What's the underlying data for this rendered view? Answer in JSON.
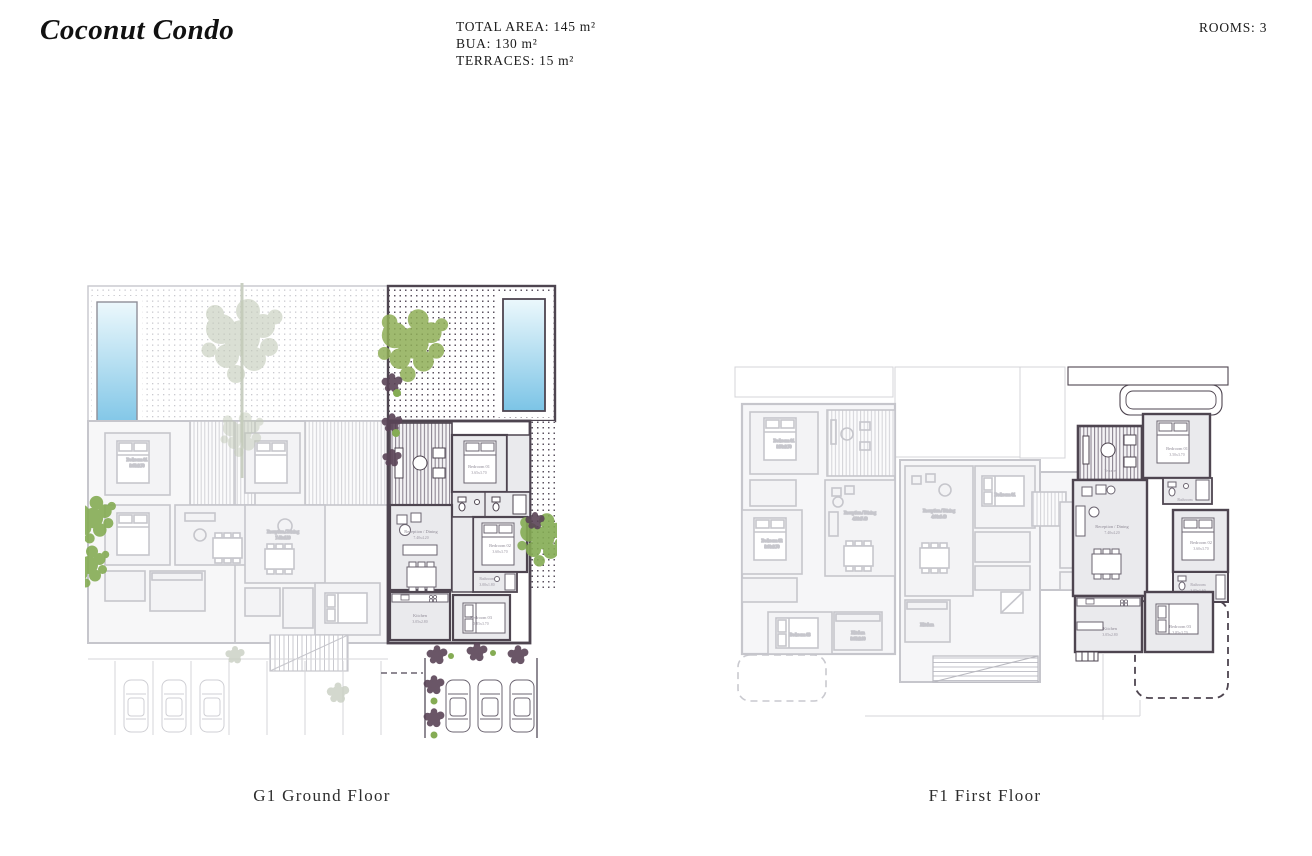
{
  "header": {
    "title": "Coconut Condo",
    "stats": {
      "total_area": "TOTAL AREA: 145 m²",
      "bua": "BUA: 130 m²",
      "terraces": "TERRACES: 15 m²"
    },
    "rooms_count": "ROOMS: 3"
  },
  "plans": {
    "ground": {
      "caption": "G1 Ground Floor",
      "rooms": {
        "bedroom1": {
          "name": "Bedroom 01",
          "dims": "3.65x3.70"
        },
        "bedroom2": {
          "name": "Bedroom 02",
          "dims": "3.60x3.70"
        },
        "bedroom3": {
          "name": "Bedroom 03",
          "dims": "3.85x3.70"
        },
        "reception": {
          "name": "Reception / Dining",
          "dims": "7.40x4.20"
        },
        "kitchen": {
          "name": "Kitchen",
          "dims": "3.05x2.80"
        },
        "bathroom": {
          "name": "Bathroom",
          "dims": "3.00x1.80"
        }
      }
    },
    "first": {
      "caption": "F1 First Floor",
      "rooms": {
        "terrace": {
          "name": "Terrace"
        },
        "bedroom1": {
          "name": "Bedroom 01",
          "dims": "3.50x3.70"
        },
        "bedroom2": {
          "name": "Bedroom 02",
          "dims": "3.60x3.70"
        },
        "bedroom3": {
          "name": "Bedroom 03",
          "dims": "3.85x3.70"
        },
        "reception": {
          "name": "Reception / Dining",
          "dims": "7.40x4.20"
        },
        "kitchen": {
          "name": "Kitchen",
          "dims": "3.05x2.80"
        },
        "bathroom": {
          "name": "Bathroom",
          "dims": "3.05x1.60"
        }
      },
      "faded_units": {
        "reception_a": {
          "name": "Reception / Dining",
          "dims": "4.20x7.40"
        },
        "reception_b": {
          "name": "Reception / Dining",
          "dims": "4.00x6.40"
        }
      }
    }
  },
  "colors": {
    "highlight_wall": "#4e4550",
    "faded_line": "#c6c6cc",
    "pool_blue": "#8ecfe9",
    "plant_green": "#85ac54",
    "plant_dark": "#5a4457"
  }
}
